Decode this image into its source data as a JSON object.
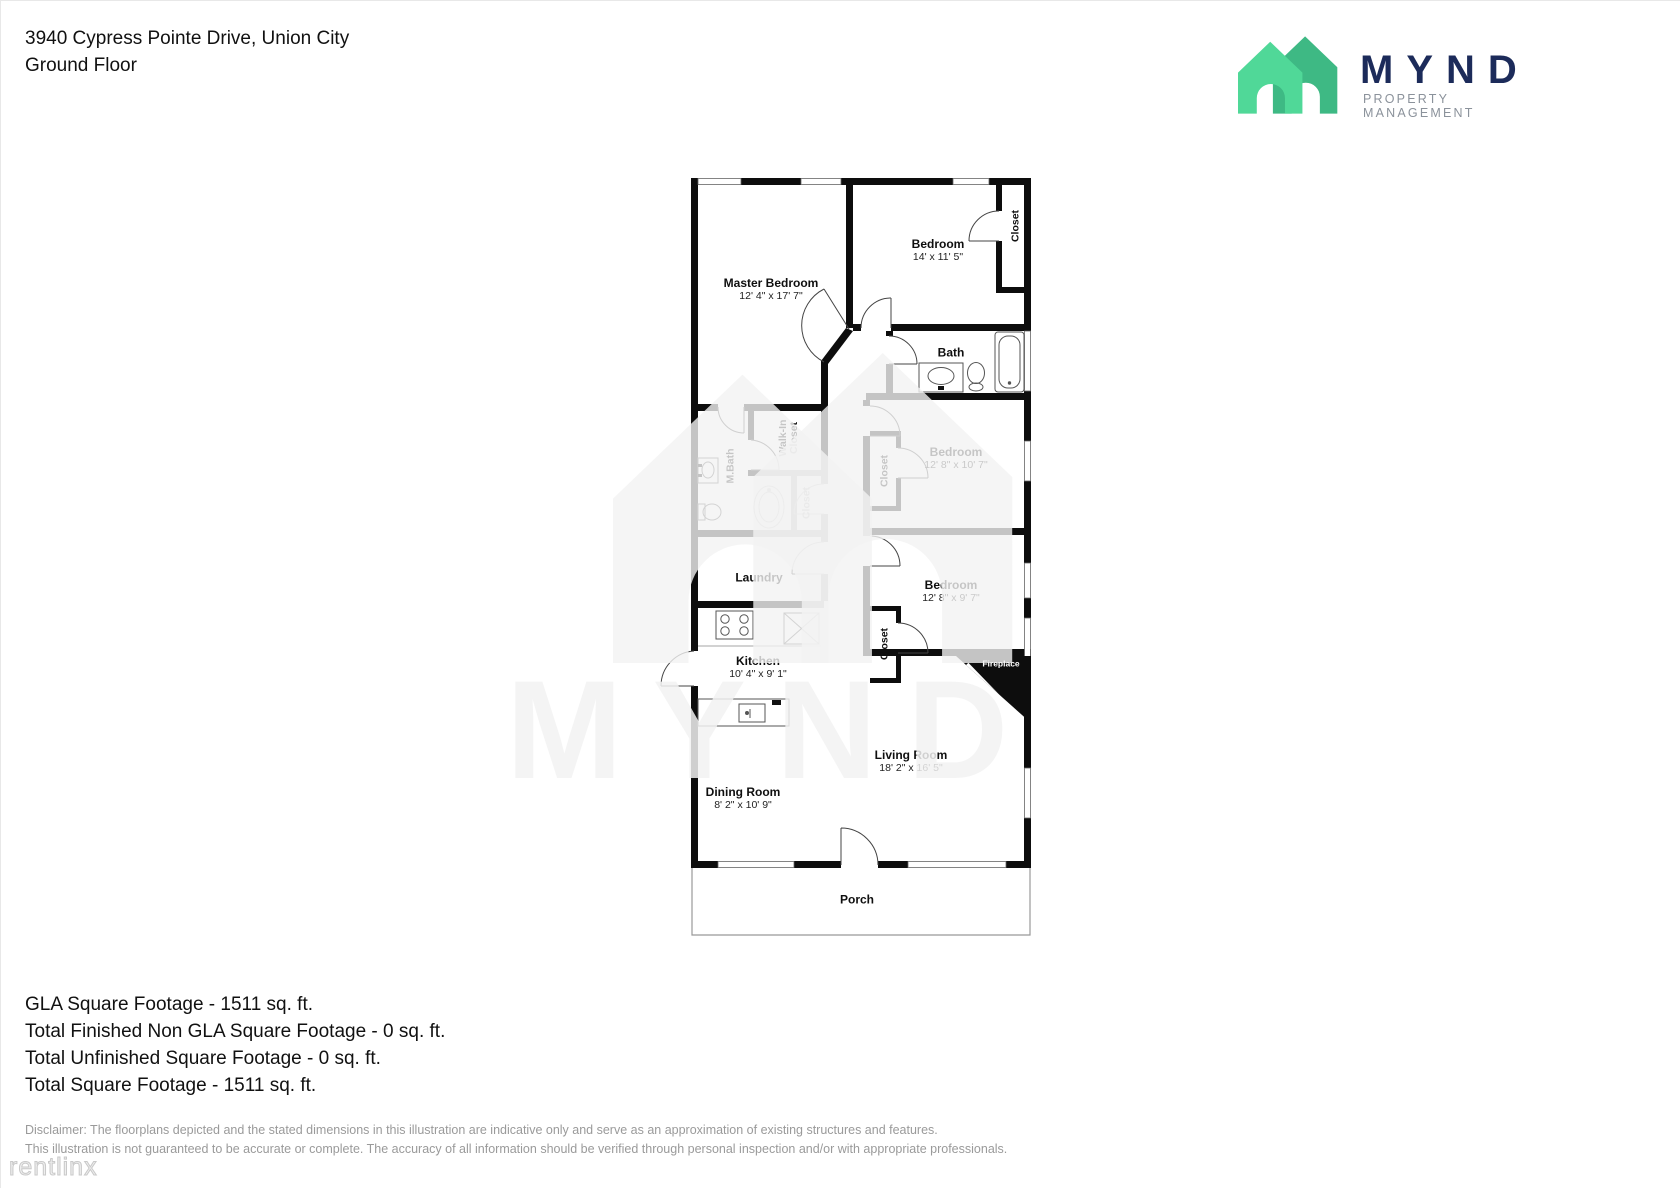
{
  "header": {
    "address": "3940 Cypress Pointe Drive, Union City",
    "floor": "Ground Floor"
  },
  "logo": {
    "brand": "MYND",
    "tagline": "PROPERTY MANAGEMENT",
    "colors": {
      "house_light_green": "#50d898",
      "house_dark_green": "#3eb984",
      "brand_navy": "#1c2b5a",
      "tagline_gray": "#8b929b"
    }
  },
  "plan": {
    "rooms": {
      "master_bedroom": {
        "name": "Master Bedroom",
        "dims": "12' 4\" x 17' 7\""
      },
      "bedroom_top": {
        "name": "Bedroom",
        "dims": "14' x 11' 5\""
      },
      "closet_top": {
        "name": "Closet"
      },
      "bath": {
        "name": "Bath"
      },
      "m_bath": {
        "name": "M.Bath"
      },
      "walk_in_closet": {
        "line1": "Walk-In",
        "line2": "Closet"
      },
      "hall_closet": {
        "name": "Closet"
      },
      "bedroom_mid": {
        "name": "Bedroom",
        "dims": "12' 8\" x 10' 7\""
      },
      "bedroom_mid_closet": {
        "name": "Closet"
      },
      "bedroom_low": {
        "name": "Bedroom",
        "dims": "12' 8\" x 9' 7\""
      },
      "bedroom_low_closet": {
        "name": "Closet"
      },
      "laundry": {
        "name": "Laundry"
      },
      "kitchen": {
        "name": "Kitchen",
        "dims": "10' 4\" x 9' 1\""
      },
      "dining_room": {
        "name": "Dining Room",
        "dims": "8' 2\" x 10' 9\""
      },
      "living_room": {
        "name": "Living Room",
        "dims": "18' 2\" x 16' 5\""
      },
      "fireplace": {
        "name": "Fireplace"
      },
      "porch": {
        "name": "Porch"
      }
    }
  },
  "summary": {
    "lines": [
      "GLA Square Footage - 1511 sq. ft.",
      "Total Finished Non GLA Square Footage - 0 sq. ft.",
      "Total Unfinished Square Footage - 0 sq. ft.",
      "Total Square Footage - 1511 sq. ft."
    ]
  },
  "disclaimer": {
    "lines": [
      "Disclaimer: The floorplans depicted and the stated dimensions in this illustration are indicative only and serve as an approximation of existing structures and features.",
      "This illustration is not guaranteed to be accurate or complete. The accuracy of all information should be verified through personal inspection and/or with appropriate professionals."
    ]
  },
  "watermarks": {
    "brand": "MYND",
    "corner": "rentlinx"
  }
}
